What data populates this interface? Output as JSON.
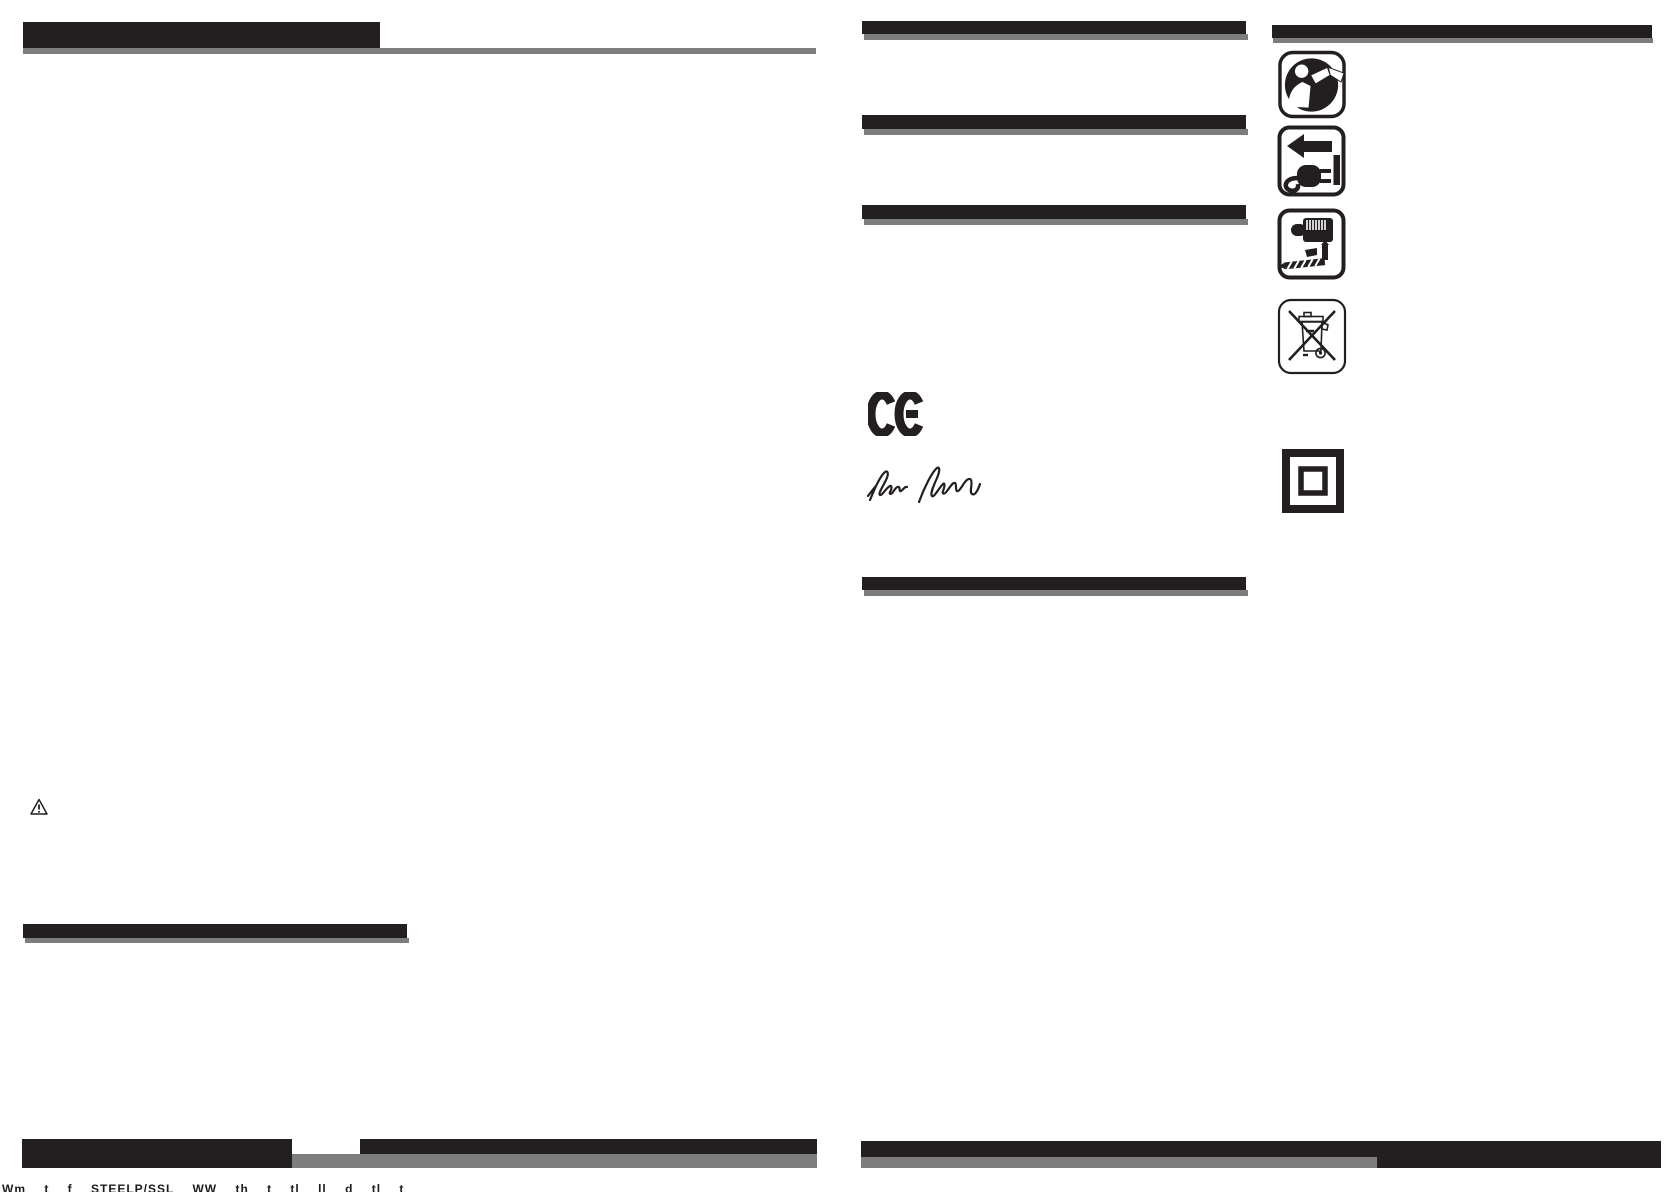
{
  "page": {
    "background": "#ffffff",
    "kind": "scanned instruction-manual page with blank redacted heading bars"
  },
  "colors": {
    "print_black": "#231f20",
    "print_gray": "#7d7d7d"
  },
  "left_page": {
    "title_bar_text": "",
    "section_bar_text": "",
    "footer_clipped_text": "Wm t f STEELP/SSL WW th t tl ll d tl t"
  },
  "middle_column": {
    "section_bar_count": 4,
    "ce_mark_label": "CE",
    "signature_present": true
  },
  "right_column": {
    "header_bar_text": "",
    "icons": [
      {
        "name": "read-manual-icon"
      },
      {
        "name": "unplug-power-icon"
      },
      {
        "name": "drill-chuck-accessories-icon"
      },
      {
        "name": "weee-crossed-bin-icon"
      },
      {
        "name": "double-insulation-icon"
      }
    ]
  },
  "misc": {
    "warning_icon": "warning-triangle-icon"
  }
}
